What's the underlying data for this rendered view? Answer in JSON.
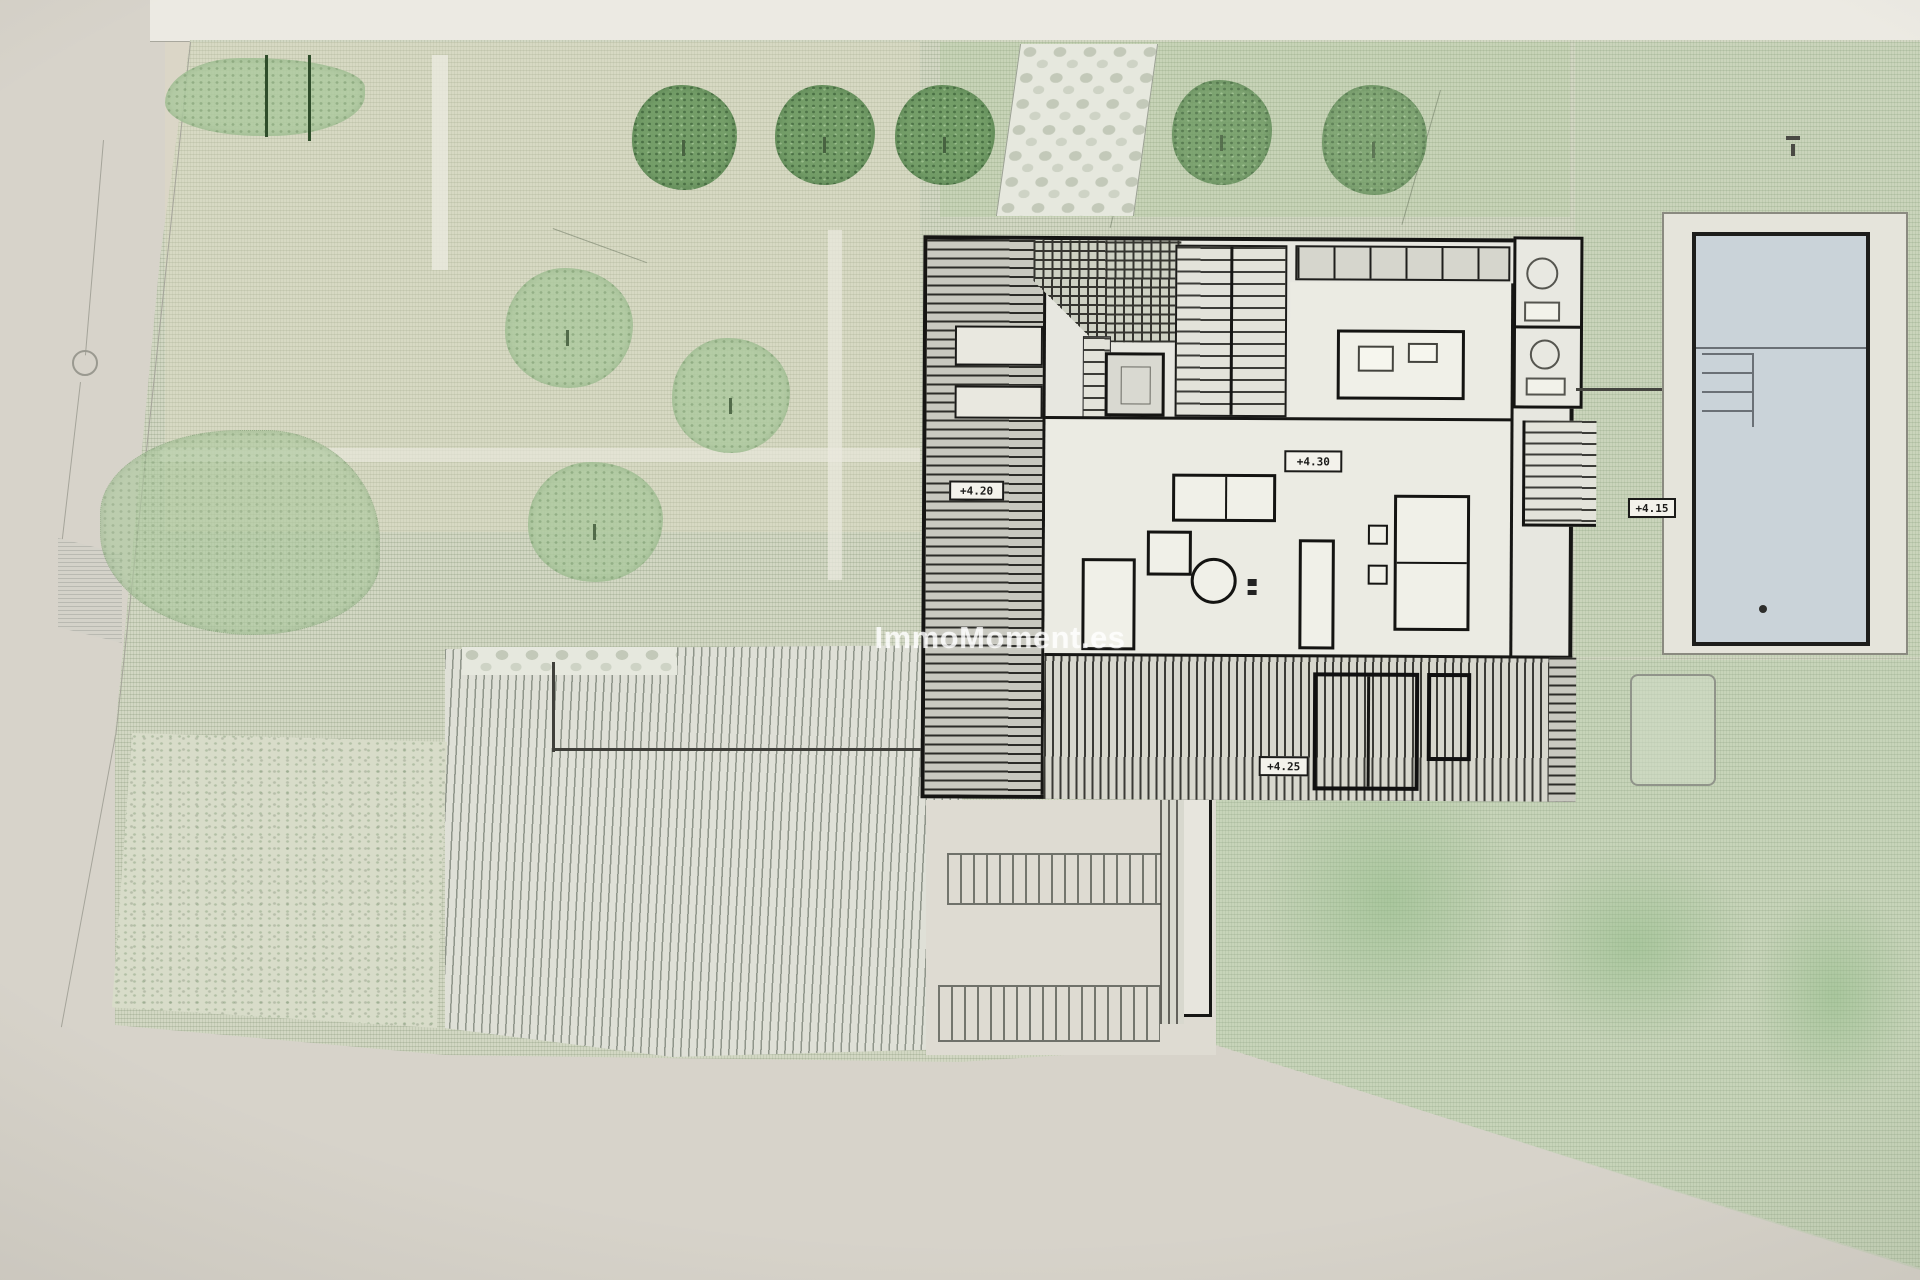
{
  "document": {
    "type": "architectural-site-plan-photo",
    "watermark": "ImmoMoment.es"
  },
  "plan": {
    "elevation_labels": {
      "deck_left": "+4.20",
      "living_room": "+4.30",
      "terrace_bottom": "+4.25",
      "pool_side": "+4.15"
    },
    "features": [
      "garden-lawn-hatched",
      "stone-path",
      "tree-row-top",
      "shrub-hedge",
      "house-floor-plan",
      "wood-deck-left",
      "pergola-grid",
      "main-staircase",
      "kitchen-island",
      "bathrooms",
      "living-room",
      "south-terrace-deck",
      "swimming-pool",
      "pool-terrace",
      "planter-box",
      "driveway-paving",
      "scrub-vegetation",
      "hedge-row",
      "boundary-line",
      "stepping-stones"
    ]
  },
  "colors": {
    "paper": "#d7d3ca",
    "plan_margin": "#eceae3",
    "grass": "#d2d7c3",
    "grass_bright": "#c7d3ba",
    "house_line": "#161614",
    "pool_water": "#cad3d9",
    "tree_dark": "#6d9a62",
    "tree_light": "#aecaa0",
    "watermark_color": "rgba(255,255,255,0.8)"
  }
}
